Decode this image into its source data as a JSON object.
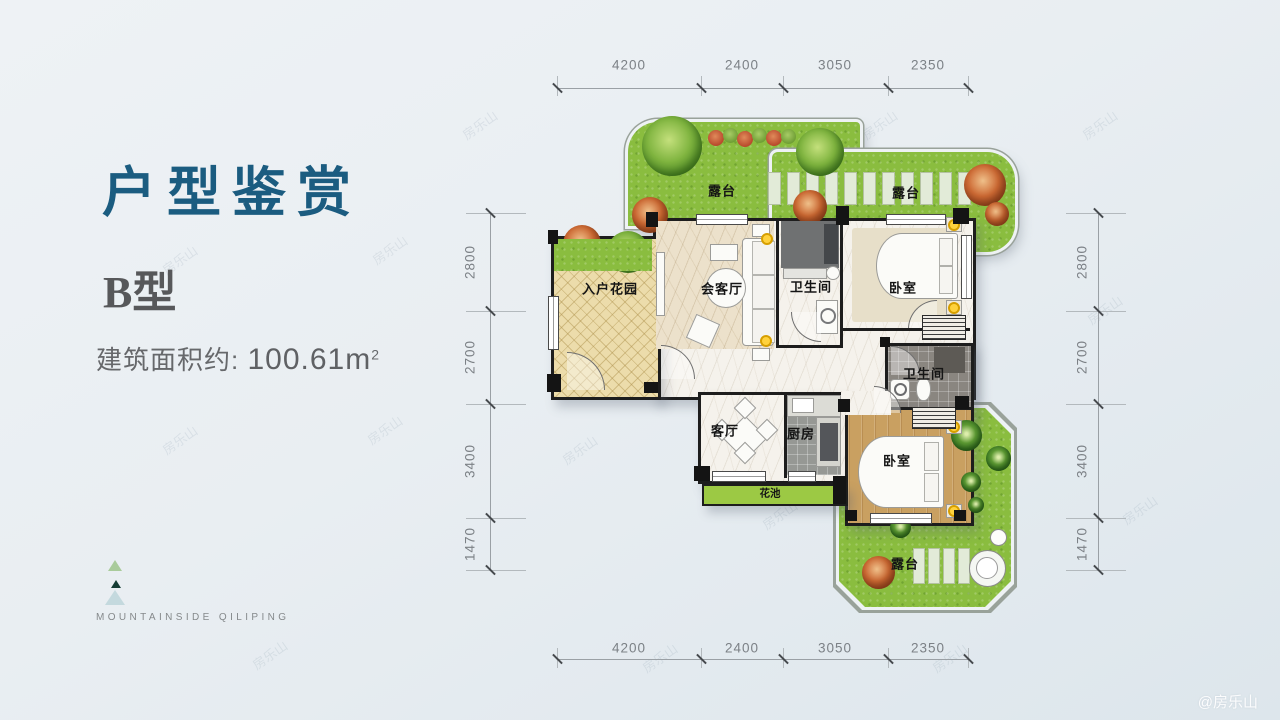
{
  "panel": {
    "title": "户型鉴赏",
    "unit_type": "B型",
    "area_label": "建筑面积约:",
    "area_value": "100.61m",
    "area_superscript": "2",
    "brand": "MOUNTAINSIDE QILIPING"
  },
  "plan": {
    "labels": {
      "terrace_top_left": "露台",
      "terrace_top_right": "露台",
      "entry_garden": "入户花园",
      "reception": "会客厅",
      "bath1": "卫生间",
      "bedroom1": "卧室",
      "bath2": "卫生间",
      "living": "客厅",
      "kitchen": "厨房",
      "flower_bed": "花池",
      "bedroom2": "卧室",
      "terrace_bottom": "露台"
    },
    "dimensions": {
      "top": [
        "4200",
        "2400",
        "3050",
        "2350"
      ],
      "bottom": [
        "4200",
        "2400",
        "3050",
        "2350"
      ],
      "left": [
        "2800",
        "2700",
        "3400",
        "1470"
      ],
      "right": [
        "2800",
        "2700",
        "3400",
        "1470"
      ]
    }
  },
  "watermark": {
    "tile": "房乐山",
    "corner": "@房乐山"
  },
  "colors": {
    "accent_title": "#1b5c80",
    "terrace_green": "#8abd3f",
    "lamp_yellow": "#ffd23d"
  }
}
